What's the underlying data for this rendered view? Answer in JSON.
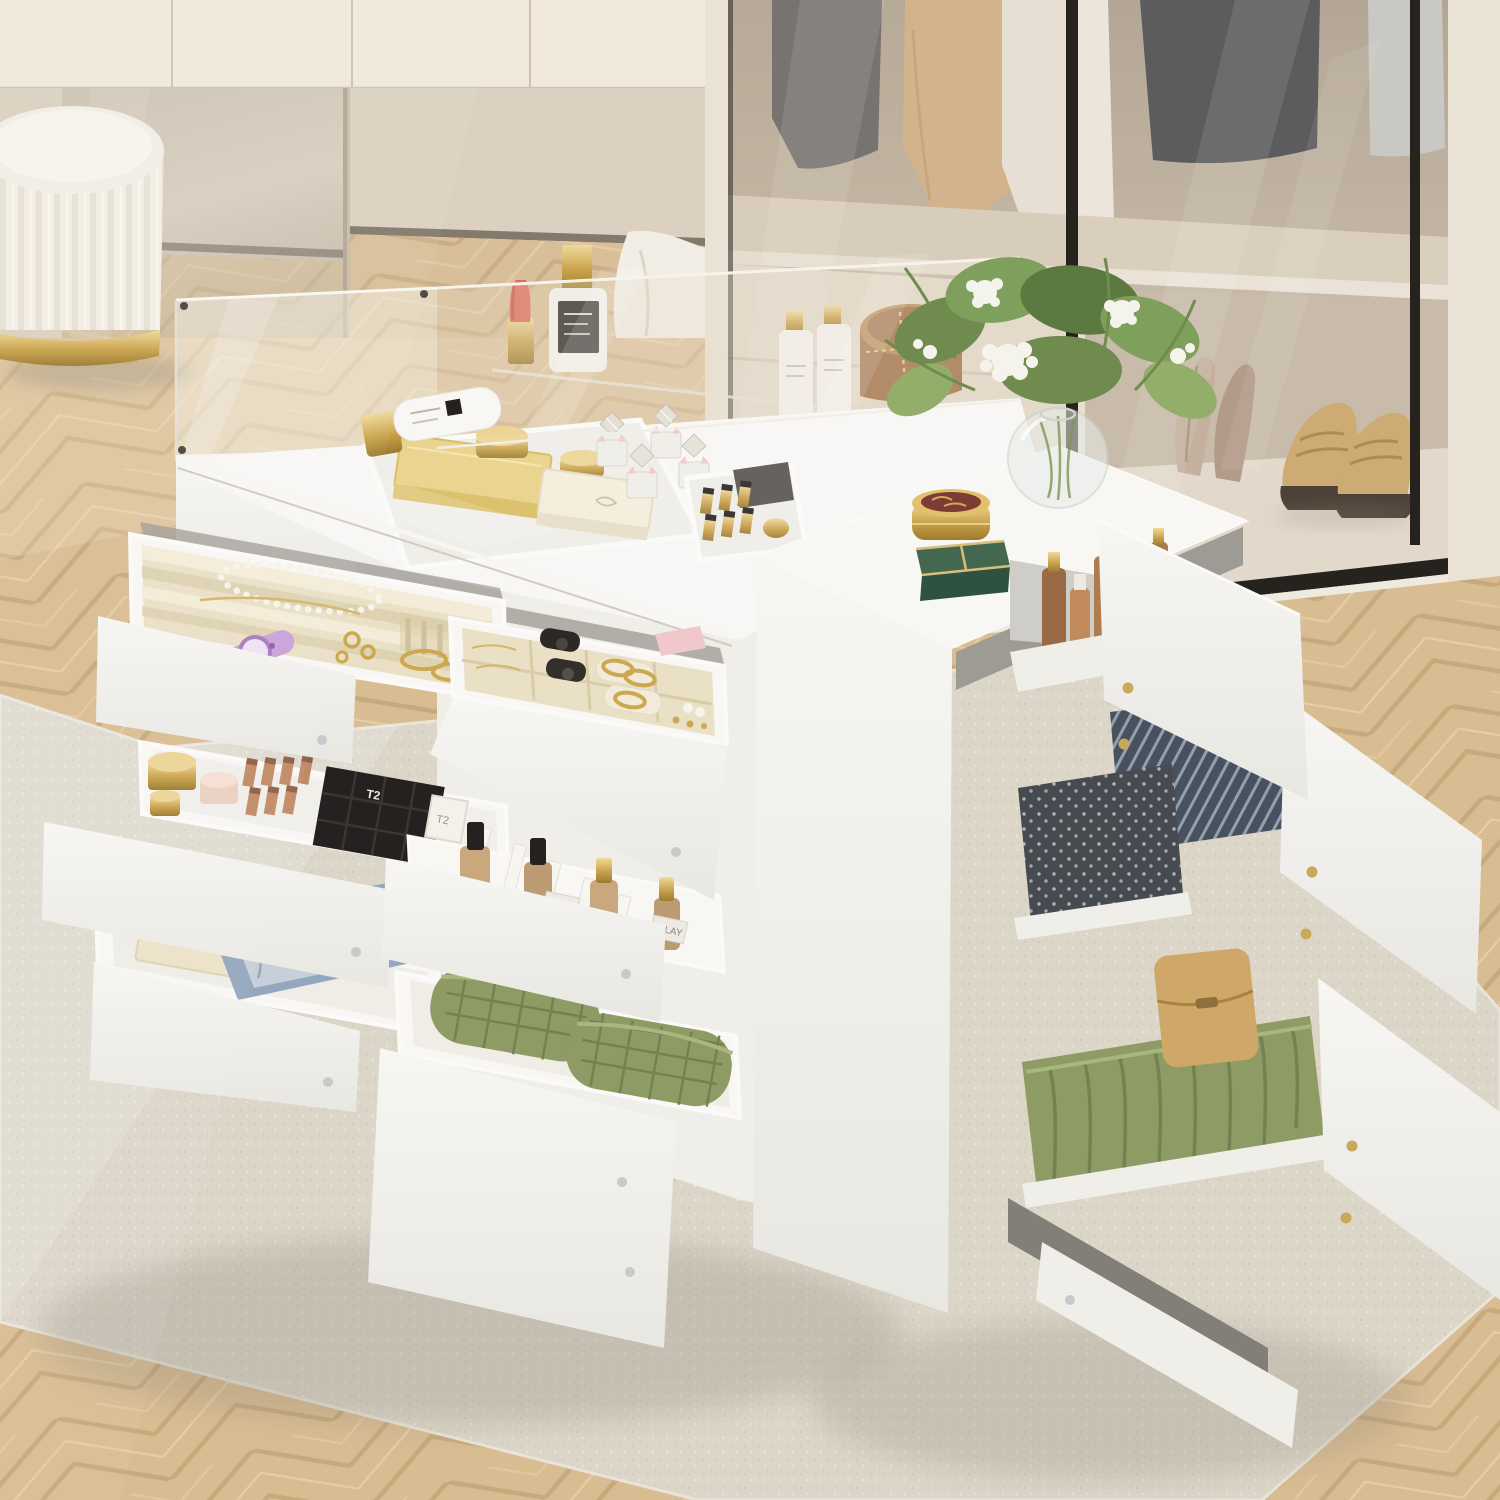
{
  "meta": {
    "description": "Product photo of a white walk-in-closet storage island dresser with glass top; many drawers pulled open showing jewelry, cosmetics, perfume and folded clothes",
    "image_type": "furniture product photograph"
  },
  "palette": {
    "wall": "#EAE2D4",
    "wallHi": "#F0E9DC",
    "seam": "#CFC3AF",
    "mirror": "#D3C9B9",
    "mirrorDark": "#C4B9A6",
    "doorwall": "#DCD1C0",
    "baseboard": "#6E6357",
    "cloth": "#F2EEE5",
    "wood": "#D8BC92",
    "woodDark": "#C5A678",
    "woodHi": "#E8D1A9",
    "rug": "#DCD6C9",
    "rugDot": "#CBC3B2",
    "rugHi": "#EBE6DB",
    "white": "#F8F7F4",
    "white2": "#EFEEE9",
    "white3": "#E3E2DD",
    "gap": "#A19E97",
    "slot": "#827F78",
    "glassTint": "#CDBCA6",
    "frame": "#26231F",
    "taupe": "#C2B5A1",
    "taupeDark": "#AD9F8B",
    "shelfCream": "#EDE6D8",
    "velvet": "#EAE0C6",
    "velvetD": "#D9CCA8",
    "velvetL": "#F4ECD8",
    "gold": "#CCA84E",
    "goldL": "#EDD494",
    "rose": "#C08A66",
    "cream": "#F2EAD5",
    "charcoal": "#55585C",
    "charcoal2": "#474B50",
    "camel": "#D6B083",
    "shirt": "#C9CBC7",
    "olive": "#8E9B64",
    "oliveD": "#74824F",
    "oliveHi": "#A9B77E",
    "navy": "#475160",
    "navyL": "#939FAB",
    "tan": "#CFA869",
    "soleD": "#352C23",
    "leather": "#9C6B3F",
    "leatherL": "#B8874F",
    "stitch": "#E2C18C",
    "jade": "#44684F",
    "jadeD": "#2F5240",
    "coral": "#E06A59",
    "pinkBow": "#F0C7CA",
    "black": "#242120",
    "silver": "#C6CACC",
    "heel": "#C4AE9D",
    "heelD": "#AE9584"
  },
  "room": {
    "left_wardrobe": {
      "cabinets": "beige cabinet fronts",
      "mirror": "mirror panel reflecting room",
      "doorway": "open section with herringbone floor and white cloth",
      "stool": "cream pleated vanity stool with gold base ring"
    },
    "closet": {
      "doors": "tinted glass sliding doors with black frames",
      "hanging_clothes": [
        "charcoal coat",
        "camel coat",
        "white coat",
        "charcoal jacket",
        "grey shirt"
      ],
      "display_items": [
        "coral lipstick",
        "white perfume bottle with gold cap",
        "two white pump bottles",
        "round brown leather jewelry case"
      ],
      "shoes": [
        "beige high heels",
        "tan penny loafers"
      ]
    },
    "floor": "light oak herringbone parquet",
    "rug": "ivory textured area rug"
  },
  "island": {
    "finish": "white",
    "left_unit": {
      "glass_back_panel": true,
      "glass_top": true,
      "items_on_glass": [
        "white cosmetic tube with gold cap"
      ],
      "top_tray_items": [
        "gold palette box",
        "two gold compacts",
        "cream keepsake box",
        "four crystal perfume bottles with pink bows",
        "gold lipstick set",
        "grey pouch"
      ],
      "drawers": [
        {
          "id": "L1",
          "type": "jewelry tray",
          "items": [
            "pearl bracelet",
            "lilac watch",
            "gold rings",
            "gold bracelets",
            "necklace chain"
          ]
        },
        {
          "id": "L2",
          "type": "jewelry organizer",
          "items": [
            "black watches",
            "gold bangles on cream rolls",
            "pearl earrings",
            "gold rings",
            "pink silk roll"
          ]
        },
        {
          "id": "L3",
          "type": "cosmetics drawer",
          "items": [
            "gold cream jars",
            "blush jar",
            "rose-gold lipsticks",
            "black lipstick boxes",
            "white lipstick boxes"
          ]
        },
        {
          "id": "L4",
          "type": "fragrance drawer",
          "items": [
            "perfume bottles with black and gold caps",
            "white divider cards"
          ]
        },
        {
          "id": "L5",
          "type": "accessories drawer",
          "items": [
            "cream stationery box",
            "floral silk scarf",
            "blue folded fabric"
          ]
        },
        {
          "id": "L6",
          "type": "textile drawer",
          "items": [
            "two green quilted towels"
          ]
        }
      ]
    },
    "right_unit": {
      "top_items": [
        "glass sphere vase",
        "white wildflower and olive bouquet",
        "gold powder compact with plum lid",
        "jade green trinket box with gold trim"
      ],
      "drawers": [
        {
          "id": "R1",
          "type": "skincare drawer",
          "items": [
            "tan and brown skincare bottles",
            "frosted bottle",
            "lime green jar"
          ]
        },
        {
          "id": "R2",
          "type": "clothing drawer",
          "items": [
            "navy striped garment",
            "charcoal polka-dot garment"
          ]
        },
        {
          "id": "R3",
          "type": "clothing drawer",
          "items": [
            "green cable-knit sweater",
            "tan leather clutch"
          ]
        },
        {
          "id": "R4",
          "type": "bottom drawer",
          "items": []
        }
      ]
    }
  },
  "labels": {
    "t2": "T2",
    "olay": "OLAY",
    "nars": "NARS"
  }
}
